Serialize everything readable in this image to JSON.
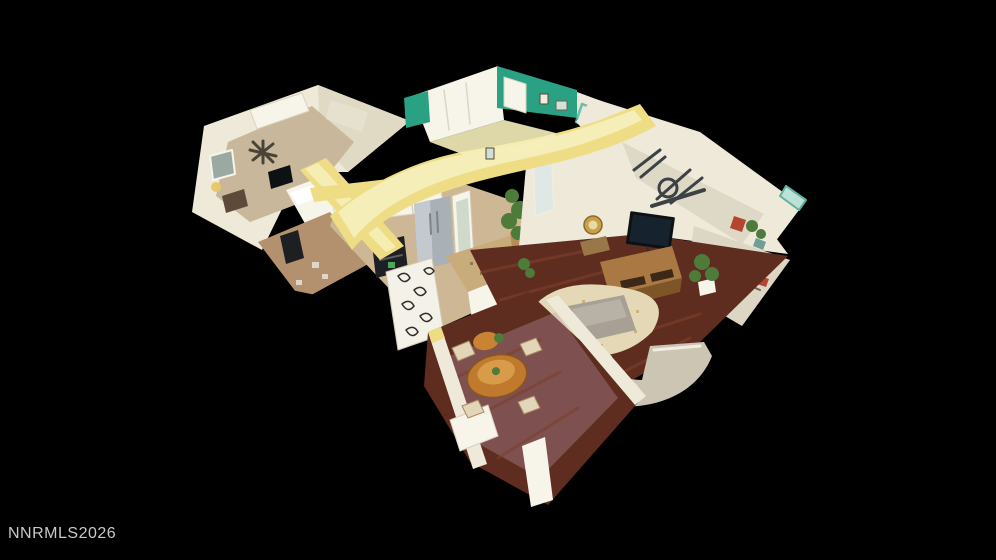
{
  "watermark": {
    "text": "NNRMLS2026"
  },
  "palette": {
    "background": "#000000",
    "watermark": "#c9c9c9",
    "cut_wall_yellow": "#eedd84",
    "cut_wall_yellow_light": "#f6eeb9",
    "wall_ivory": "#eee9d8",
    "wall_white": "#f7f4ea",
    "accent_green": "#2aa183",
    "teal_glass": "#5bb3a0",
    "floor_wood_dark": "#5e2d1f",
    "floor_wood_mid": "#7c3e2a",
    "floor_tile": "#cdb795",
    "hall_tan": "#b3916e",
    "carpet_beige": "#c9b79b",
    "granite": "#c8ac7c",
    "steel": "#a9b0b6",
    "appliance_black": "#1d1f22",
    "tv_black": "#0e1114",
    "wood_console": "#a97843",
    "wood_console_dark": "#7e5527",
    "table_wood": "#bf7a2e",
    "table_wood_light": "#d89b4a",
    "rug_cream": "#e4d8b6",
    "rug_speckle": "#c9b27f",
    "sofa_beige": "#cdc5b4",
    "sofa_trim": "#f0ede3",
    "ottoman_gray": "#a8a094",
    "plant_green": "#4e7a3a",
    "gold": "#c8a048",
    "haze_pink": "#c49ab5",
    "blanket_teal": "#9fc4bb",
    "clutter_red": "#b4452f"
  }
}
